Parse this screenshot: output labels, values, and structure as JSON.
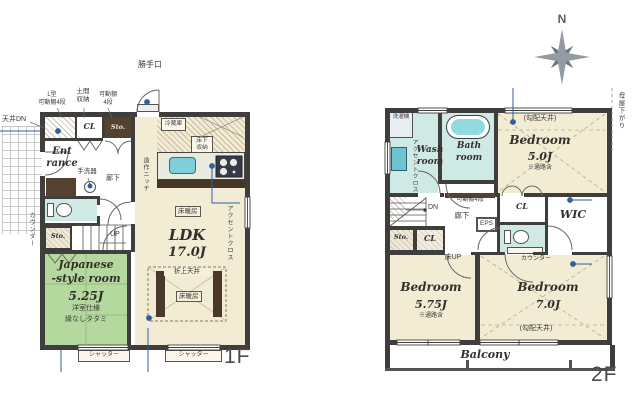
{
  "compass": {
    "north_label": "N"
  },
  "floor1": {
    "floor_label": "1F",
    "ldk": {
      "name": "LDK",
      "size": "17.0J"
    },
    "japanese_room": {
      "name": "Japanese\n-style room",
      "size": "5.25J",
      "note1": "洋室仕様",
      "note2": "縁なしタタミ"
    },
    "entrance": {
      "name": "Ent\nrance"
    },
    "labels": {
      "katteguchi": "勝手口",
      "l_shelf": "L型\n可動棚4段",
      "doma_storage": "土間\n収納",
      "shelf_4": "可動棚\n4段",
      "ceiling_dn": "天井DN",
      "cl": "CL",
      "sto_upper": "Sto.",
      "sto_lower": "Sto.",
      "fridge": "冷蔵庫",
      "underfloor_storage": "床下\n収納",
      "niche": "造作ニッチ",
      "floor_heating": "床暖房",
      "oriage_ceiling": "折上天井",
      "accent_cloth": "アクセントクロス",
      "counter": "カウンター",
      "hand_basin": "手洗器",
      "hallway": "廊下",
      "up": "UP",
      "shutter": "シャッター"
    }
  },
  "floor2": {
    "floor_label": "2F",
    "bedroom_50": {
      "name": "Bedroom",
      "size": "5.0J",
      "ceiling": "(勾配天井)",
      "note": "※通路含"
    },
    "bedroom_575": {
      "name": "Bedroom",
      "size": "5.75J",
      "note": "※通路含"
    },
    "bedroom_70": {
      "name": "Bedroom",
      "size": "7.0J",
      "ceiling": "(勾配天井)"
    },
    "wash_room": {
      "name": "Wash\nroom"
    },
    "bath_room": {
      "name": "Bath\nroom"
    },
    "wic": {
      "name": "WIC"
    },
    "balcony": {
      "name": "Balcony"
    },
    "labels": {
      "washer": "洗濯機",
      "accent_cloth": "アクセントクロス",
      "moya_sagari": "母屋下がり",
      "dn": "DN",
      "shelf_4": "可動棚4段",
      "hallway": "廊下",
      "eps": "EPS",
      "sto": "Sto.",
      "cl_stairs": "CL",
      "cl_bedroom": "CL",
      "floor_up": "床UP",
      "counter": "カウンター"
    }
  }
}
